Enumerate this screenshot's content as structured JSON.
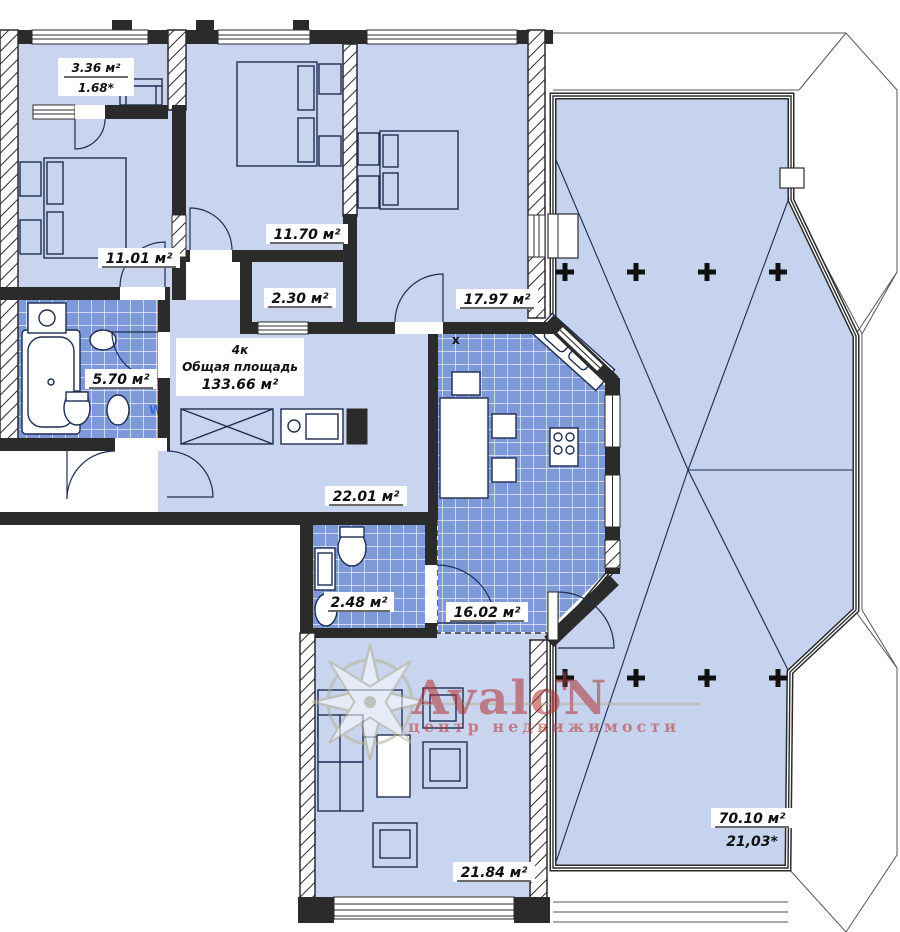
{
  "watermark": {
    "brand": "AvaloN",
    "tagline": "центр недвижимости",
    "plus": "+"
  },
  "summary": {
    "type": "4к",
    "label": "Общая площадь",
    "total_area": "133.66 м²"
  },
  "rooms": {
    "balcony": {
      "area": "3.36 м²",
      "reduced": "1.68*"
    },
    "bedroom1": {
      "area": "11.01 м²"
    },
    "bedroom2": {
      "area": "11.70 м²"
    },
    "closet": {
      "area": "2.30 м²"
    },
    "bedroom3": {
      "area": "17.97 м²"
    },
    "bathroom": {
      "area": "5.70 м²",
      "washer_mark": "W"
    },
    "hall": {
      "area": "22.01 м²"
    },
    "wc": {
      "area": "2.48 м²"
    },
    "kitchen": {
      "area": "16.02 м²",
      "vent_mark": "x"
    },
    "living": {
      "area": "21.84 м²"
    },
    "terrace": {
      "area": "70.10 м²",
      "reduced": "21,03*"
    }
  },
  "colors": {
    "room_fill": "#c9d5ee",
    "tile_fill": "#7e99d8",
    "wall": "#2b2b2b",
    "line": "#1c2b4e",
    "brand_red": "#b03030",
    "compass": "#b7b194"
  }
}
